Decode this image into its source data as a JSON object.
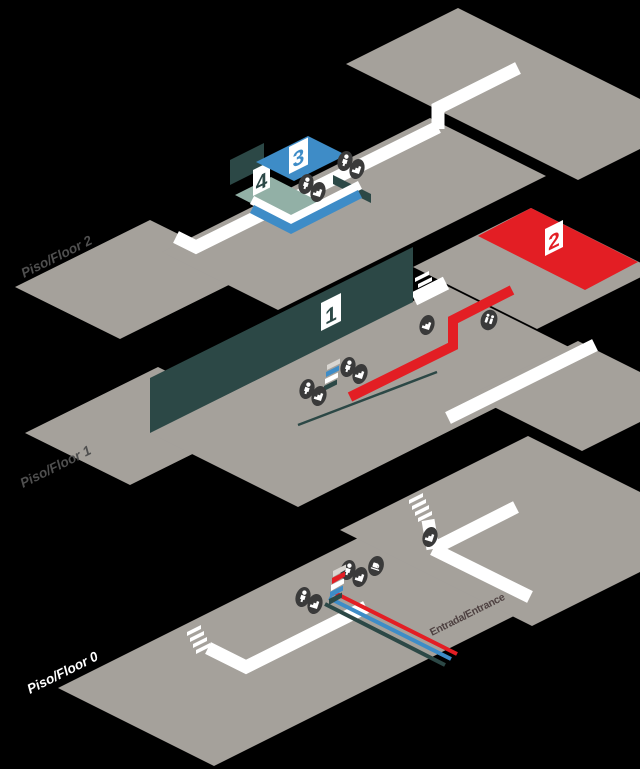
{
  "map_title": "Isometric venue floor map",
  "floors": [
    {
      "id": "floor-2",
      "label": "Piso/Floor 2",
      "zones": [
        {
          "number": "3",
          "color": "#3e8cc7"
        },
        {
          "number": "4",
          "color": "#92b0a6"
        }
      ]
    },
    {
      "id": "floor-1",
      "label": "Piso/Floor 1",
      "zones": [
        {
          "number": "1",
          "color": "#2c4846"
        },
        {
          "number": "2",
          "color": "#e31e24"
        }
      ]
    },
    {
      "id": "floor-0",
      "label": "Piso/Floor 0",
      "zones": []
    }
  ],
  "entrance": {
    "label": "Entrada/Entrance",
    "line_colors": [
      "#e31e24",
      "#3e8cc7",
      "#2c4846"
    ]
  },
  "icons": [
    {
      "type": "elevator",
      "x": 345,
      "y": 161
    },
    {
      "type": "stairs",
      "x": 357,
      "y": 169
    },
    {
      "type": "elevator",
      "x": 306,
      "y": 184
    },
    {
      "type": "stairs",
      "x": 318,
      "y": 192
    },
    {
      "type": "elevator",
      "x": 348,
      "y": 367
    },
    {
      "type": "stairs",
      "x": 360,
      "y": 374
    },
    {
      "type": "escalator-blue",
      "x": 331,
      "y": 381,
      "rot": 0
    },
    {
      "type": "elevator",
      "x": 307,
      "y": 389
    },
    {
      "type": "stairs",
      "x": 319,
      "y": 396
    },
    {
      "type": "stairs",
      "x": 427,
      "y": 325
    },
    {
      "type": "restroom",
      "x": 489,
      "y": 320
    },
    {
      "type": "stairs",
      "x": 430,
      "y": 537
    },
    {
      "type": "elevator",
      "x": 348,
      "y": 570
    },
    {
      "type": "stairs",
      "x": 360,
      "y": 577
    },
    {
      "type": "cafe",
      "x": 376,
      "y": 566
    },
    {
      "type": "escalator-red",
      "x": 336,
      "y": 590,
      "rot": 0
    },
    {
      "type": "elevator",
      "x": 303,
      "y": 597
    },
    {
      "type": "stairs",
      "x": 315,
      "y": 604
    }
  ],
  "colors": {
    "background": "#000000",
    "floor_gray": "#a5a19b",
    "path_white": "#ffffff",
    "accent_blue": "#3e8cc7",
    "accent_sage": "#92b0a6",
    "accent_dark_teal": "#2c4846",
    "accent_red": "#e31e24",
    "icon_dark": "#3a3a3a",
    "label_gray": "#4f4f4f"
  }
}
